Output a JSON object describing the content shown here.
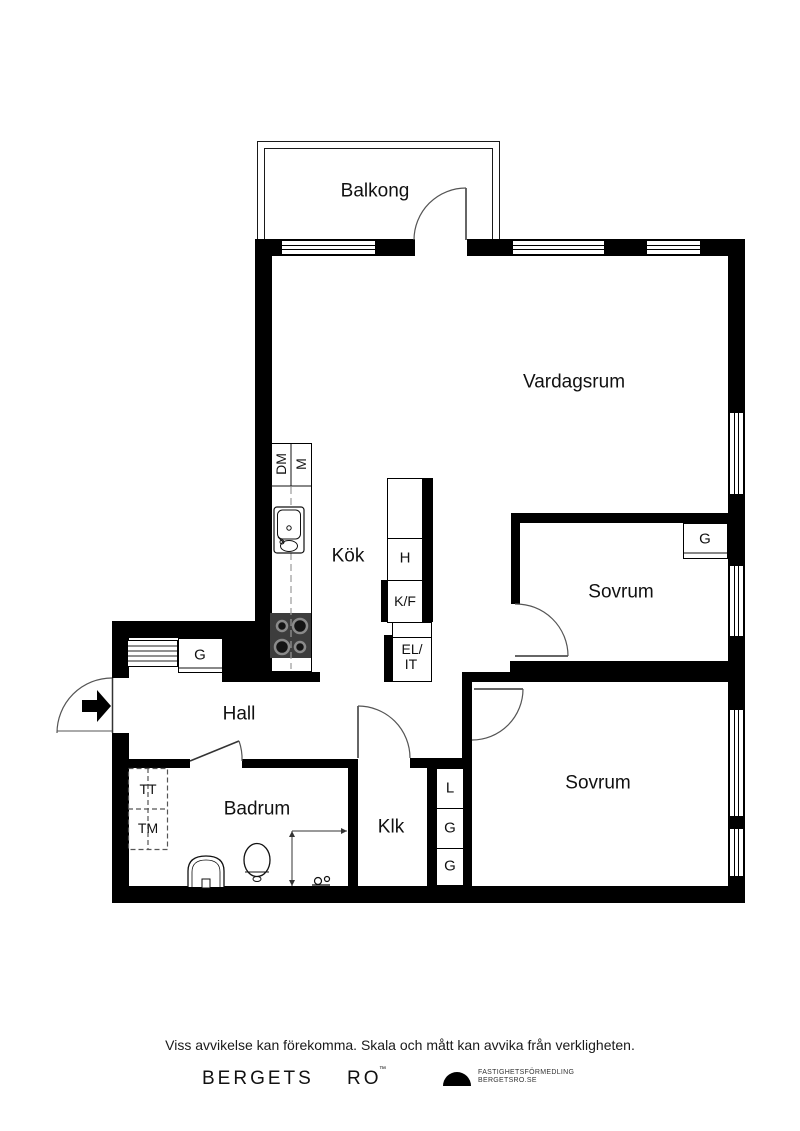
{
  "plan": {
    "rooms": {
      "balkong": "Balkong",
      "vardagsrum": "Vardagsrum",
      "kok": "Kök",
      "hall": "Hall",
      "badrum": "Badrum",
      "klk": "Klk",
      "sovrum_1": "Sovrum",
      "sovrum_2": "Sovrum"
    },
    "fixtures": {
      "dm": "DM",
      "m": "M",
      "h": "H",
      "kf": "K/F",
      "el": "EL/",
      "it": "IT",
      "g_hall": "G",
      "g_sovrum": "G",
      "l": "L",
      "g_1": "G",
      "g_2": "G",
      "tt": "TT",
      "tm": "TM"
    }
  },
  "footer": {
    "disclaimer": "Viss avvikelse kan förekomma. Skala och mått kan avvika från verkligheten.",
    "brand_word_1": "BERGETS",
    "brand_word_2": "RO",
    "brand_mark": "™",
    "agency_line_1": "FASTIGHETSFÖRMEDLING",
    "agency_line_2": "BERGETSRO.SE"
  },
  "colors": {
    "wall": "#000000",
    "stove": "#3d3d3d",
    "line": "#555555"
  }
}
